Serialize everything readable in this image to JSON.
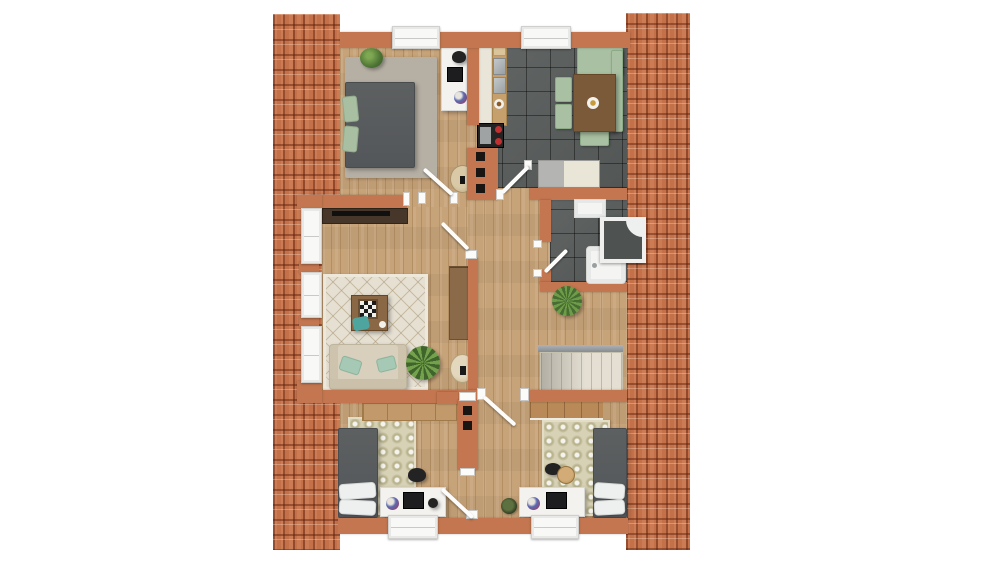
{
  "scene": {
    "title": "Attic floor plan (top-down 3D render)",
    "canvas": {
      "width": 1000,
      "height": 562
    },
    "visible_text": "none"
  },
  "palette": {
    "background": "#ffffff",
    "roof_tile": "#c4714a",
    "roof_groove": "#7e3c1e",
    "wall": "#c3764f",
    "wood_floor": "#c7a379",
    "dark_tile_floor": "#575b5a",
    "white_fixture": "#f6f6f4",
    "bed_gray": "#5a5d5f",
    "pillow_green": "#a9bfa1",
    "kitchen_seat_green": "#a9c0a2",
    "table_wood": "#7b5a3a",
    "rug_cream": "#e6e0d3",
    "rug_olive": "#d7d1b6",
    "sofa_beige": "#d8cfbd",
    "teal_cushion": "#4ea5a0",
    "stove_burner_red": "#c03030",
    "plant_green": "#4d7434"
  },
  "rooms": [
    {
      "name": "bedroom-top-left",
      "floor": "wood",
      "furniture": [
        "double bed with green pillows",
        "striped shag rug",
        "potted plant",
        "white desk with laptop, globe and black chair",
        "window"
      ]
    },
    {
      "name": "kitchen",
      "floor": "dark-tile",
      "furniture": [
        "counter with double steel sink",
        "stove with red burners",
        "fridge",
        "dining table with green corner bench and three green chairs",
        "window"
      ]
    },
    {
      "name": "living-room",
      "floor": "wood",
      "furniture": [
        "tv sideboard",
        "diamond-pattern rug",
        "coffee table with checkerboard",
        "beige sofa with mint pillows",
        "potted plant",
        "wardrobe",
        "round side table",
        "three dormer windows"
      ]
    },
    {
      "name": "bathroom",
      "floor": "dark-tile",
      "furniture": [
        "washbasin",
        "corner shower",
        "bathtub",
        "door"
      ]
    },
    {
      "name": "hallway",
      "floor": "wood",
      "furniture": [
        "round table",
        "spiky plant",
        "staircase with railing"
      ]
    },
    {
      "name": "bedroom-bottom-left",
      "floor": "wood",
      "furniture": [
        "wardrobe band",
        "olive pattern rug",
        "single bed with white pillows",
        "white desk with monitor and globe",
        "black chair",
        "window"
      ]
    },
    {
      "name": "bedroom-bottom-right",
      "floor": "wood",
      "furniture": [
        "olive pattern rug",
        "single bed with white pillows",
        "white desk with monitor and globe",
        "wooden stool",
        "potted plant",
        "window"
      ]
    }
  ],
  "counts": {
    "doors": 6,
    "windows": 7,
    "roof_strips": 2
  }
}
